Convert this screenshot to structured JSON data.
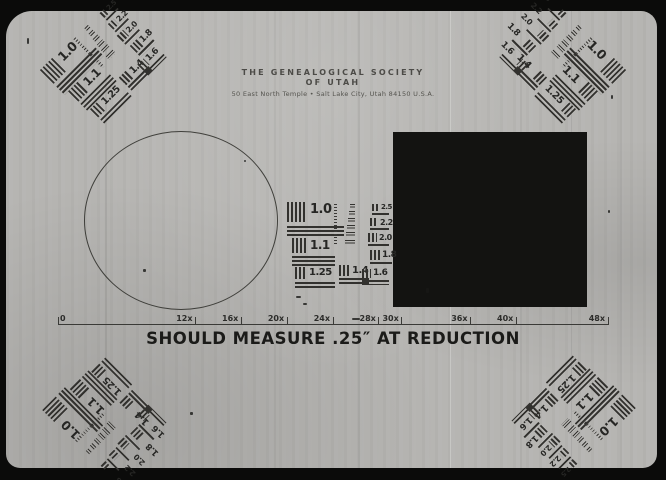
{
  "header": {
    "line1": "THE GENEALOGICAL SOCIETY",
    "line2": "OF UTAH",
    "line3": "50 East North Temple • Salt Lake City, Utah 84150 U.S.A."
  },
  "caption": "SHOULD MEASURE .25″ AT REDUCTION",
  "ruler": {
    "zero_label": "0",
    "ticks": [
      {
        "v": 12,
        "label": "12x"
      },
      {
        "v": 16,
        "label": "16x"
      },
      {
        "v": 20,
        "label": "20x"
      },
      {
        "v": 24,
        "label": "24x"
      },
      {
        "v": 28,
        "label": "28x"
      },
      {
        "v": 30,
        "label": "30x"
      },
      {
        "v": 36,
        "label": "36x"
      },
      {
        "v": 40,
        "label": "40x"
      },
      {
        "v": 48,
        "label": "48x"
      }
    ]
  },
  "targets": {
    "labels": [
      "1.0",
      "1.1",
      "1.25",
      "1.4",
      "1.6",
      "1.8",
      "2.0",
      "2.2",
      "2.5"
    ],
    "micro_rows": 6
  },
  "colors": {
    "film": "#b6b5b2",
    "frame": "#0b0b0a",
    "ink": "#32312e",
    "density_patch": "#131311",
    "caption_text": "#1b1b19"
  }
}
